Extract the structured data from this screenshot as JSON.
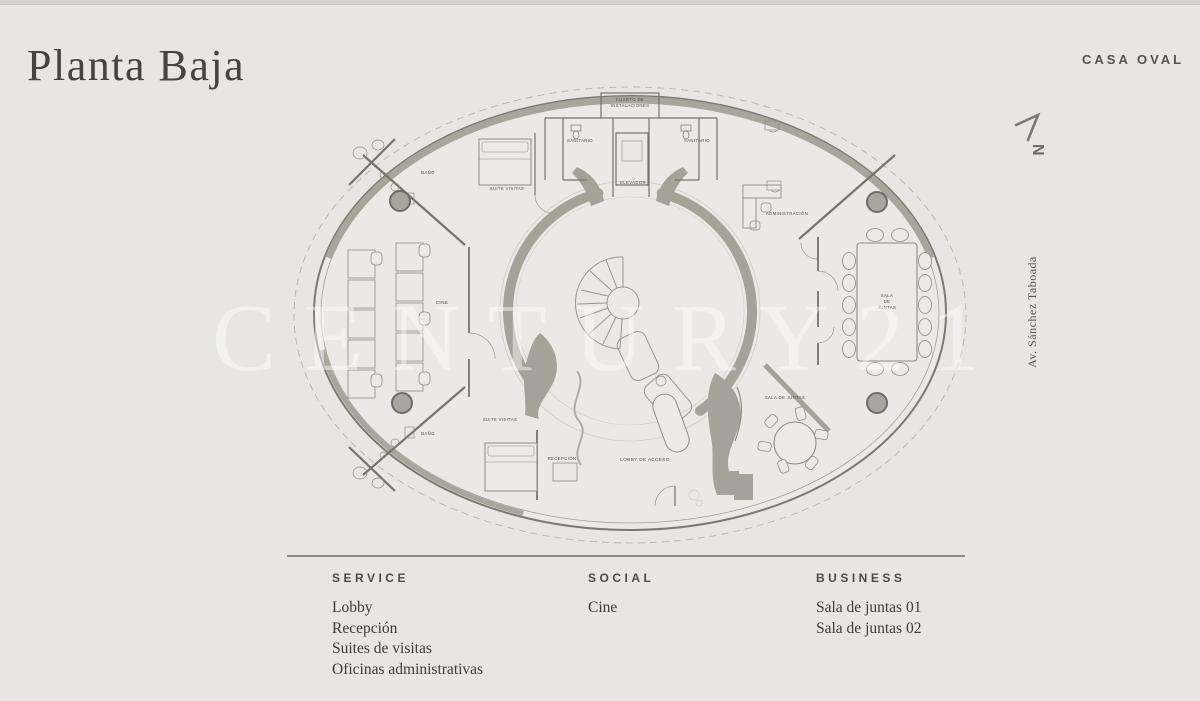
{
  "header": {
    "title": "Planta Baja",
    "brand": "CASA OVAL"
  },
  "compass": {
    "label": "N"
  },
  "street_label": "Av. Sánchez Taboada",
  "watermark": "CENTURY21",
  "plan": {
    "rooms": {
      "cuarto_1": "CUARTO DE",
      "cuarto_2": "INSTALACIONES",
      "sanitario_left": "SANITARIO",
      "sanitario_right": "SANITARIO",
      "elevador": "ELEVADOR",
      "bano_nw": "BAÑO",
      "suite_nw": "SUITE VISITAS",
      "cine": "CINE",
      "administracion": "ADMINISTRACIÓN",
      "sala_e_1": "SALA",
      "sala_e_2": "DE",
      "sala_e_3": "JUNTAS",
      "bano_sw": "BAÑO",
      "suite_sw": "SUITE VISITAS",
      "recepcion": "RECEPCIÓN",
      "lobby": "LOBBY DE ACCESO",
      "sala_se": "SALA DE JUNTAS"
    }
  },
  "legend": {
    "columns": [
      {
        "title": "SERVICE",
        "items": [
          "Lobby",
          "Recepción",
          "Suites de visitas",
          "Oficinas administrativas"
        ]
      },
      {
        "title": "SOCIAL",
        "items": [
          "Cine"
        ]
      },
      {
        "title": "BUSINESS",
        "items": [
          "Sala de juntas 01",
          "Sala de juntas 02"
        ]
      }
    ]
  }
}
